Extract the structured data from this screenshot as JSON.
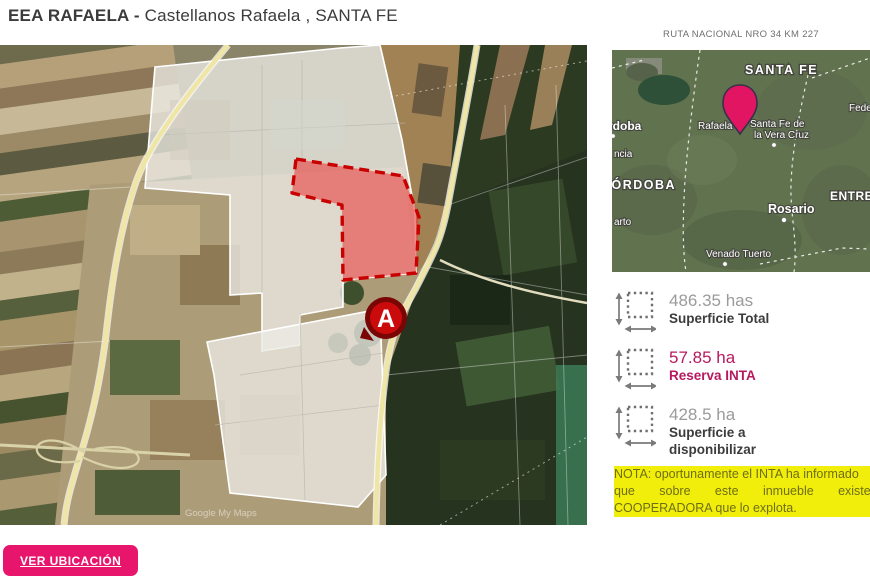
{
  "header": {
    "title_bold": "EEA RAFAELA -",
    "title_rest": " Castellanos Rafaela , SANTA FE"
  },
  "main_map": {
    "marker_label": "A",
    "watermark": "Google My Maps"
  },
  "mini_map": {
    "caption": "RUTA NACIONAL NRO 34 KM 227",
    "provinces": {
      "santa_fe": "SANTA FE",
      "cordoba": "CÓRDOBA",
      "entre_rios": "ENTRE RÍOS"
    },
    "cities": {
      "cordoba": "Córdoba",
      "rafaela": "Rafaela",
      "santa_fe_line1": "Santa Fe de",
      "santa_fe_line2": "la Vera Cruz",
      "rosario": "Rosario",
      "venado_tuerto": "Venado Tuerto",
      "federacion": "Federación",
      "frag_ncia": "ncia",
      "frag_arto": "arto"
    }
  },
  "stats": [
    {
      "value": "486.35 has",
      "label": "Superficie Total",
      "highlight": false
    },
    {
      "value": "57.85 ha",
      "label": "Reserva INTA",
      "highlight": true
    },
    {
      "value": "428.5 ha",
      "label": "Superficie a disponibilizar",
      "highlight": false
    }
  ],
  "note": {
    "lines": [
      "NOTA: oportunamente el INTA ha informado",
      "que sobre este inmueble existe una",
      "COOPERADORA que lo explota."
    ]
  },
  "actions": {
    "ver_ubicacion": "VER UBICACIÓN"
  },
  "colors": {
    "accent_pink": "#e8156d",
    "stat_pink": "#b7195f",
    "note_yellow": "#f2ee0b",
    "reserve_zone_red": "#c80000",
    "pin_pink": "#e21563"
  }
}
